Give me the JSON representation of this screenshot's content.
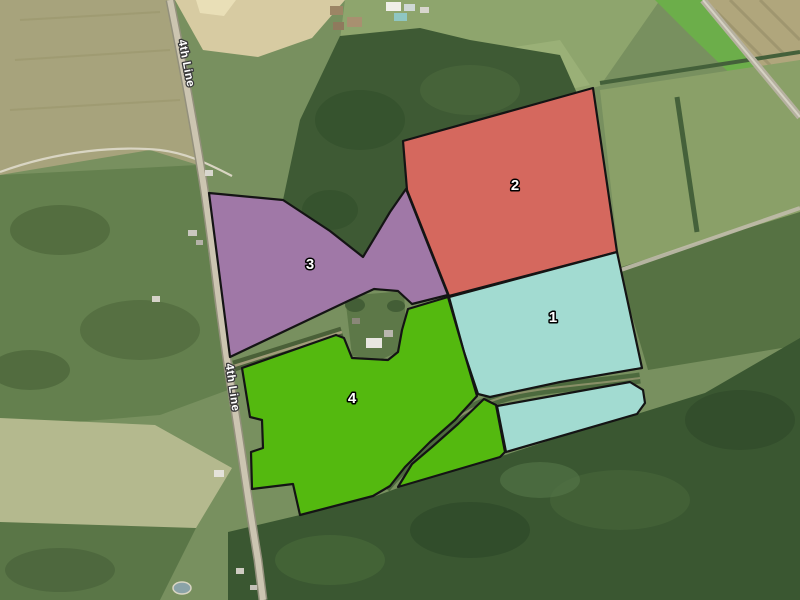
{
  "map": {
    "kind": "satellite-parcel-overlay-map"
  },
  "parcels": [
    {
      "id": "1",
      "label": "1",
      "color": "#a2dbd1"
    },
    {
      "id": "2",
      "label": "2",
      "color": "#d5685e"
    },
    {
      "id": "3",
      "label": "3",
      "color": "#a078a7"
    },
    {
      "id": "4",
      "label": "4",
      "color": "#54b90f"
    }
  ],
  "road_labels": [
    {
      "text": "4th Line"
    },
    {
      "text": "4th Line"
    }
  ],
  "style": {
    "parcel_outline": "#141414",
    "parcel_label_color": "#ffffff",
    "parcel_label_halo": "#000000",
    "road_label_color": "#ffffff",
    "road_label_halo": "#3b3b3b"
  }
}
